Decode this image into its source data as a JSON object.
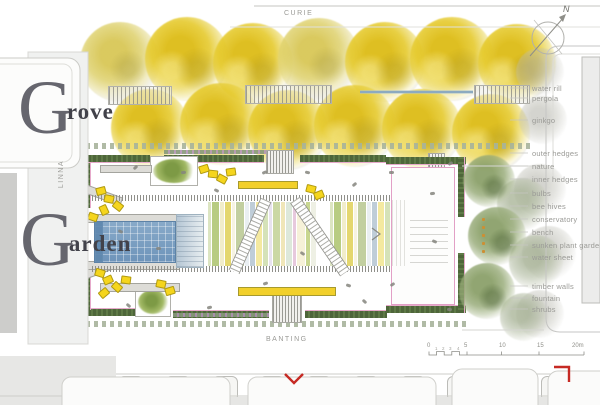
{
  "title": {
    "line1_initial": "G",
    "line1_rest": "rove",
    "line2_initial": "G",
    "line2_rest": "arden"
  },
  "streets": {
    "top": "CURIE",
    "left": "LINNA",
    "bottom": "BANTING"
  },
  "compass": {
    "north": "N"
  },
  "legend": {
    "items": [
      "water rill",
      "pergola",
      "ginkgo",
      "outer hedges",
      "nature",
      "inner hedges",
      "bulbs",
      "bee hives",
      "conservatory",
      "bench",
      "sunken plant garden",
      "water sheet",
      "timber walls",
      "fountain",
      "shrubs"
    ]
  },
  "scale_bar": {
    "major_labels": [
      "0",
      "5",
      "10",
      "15",
      "20m"
    ],
    "minor_labels": [
      "1",
      "2",
      "3",
      "4"
    ]
  },
  "colors": {
    "ginkgo_yellow": "#e5c822",
    "hedge_green": "#52683d",
    "water_blue": "#7aa0c2",
    "bench_yellow": "#f3d21c",
    "accent_pink": "#e5a4c8",
    "accent_red": "#c62a24",
    "label_gray": "#9b9b97",
    "stripe_palette": [
      "#ffffff",
      "#dce5c2",
      "#b8cc82",
      "#f1edcb",
      "#e4d76f",
      "#f7f4e2",
      "#c2cfa0",
      "#eaeff2",
      "#bfcdd8",
      "#f4e9a0",
      "#d5e2b8",
      "#e8e3ef",
      "#cbd8a4",
      "#f0e6b8",
      "#dde8da",
      "#e7c9dd",
      "#f6f1d8",
      "#c8d690",
      "#eef0e4",
      "#ffffff"
    ]
  }
}
